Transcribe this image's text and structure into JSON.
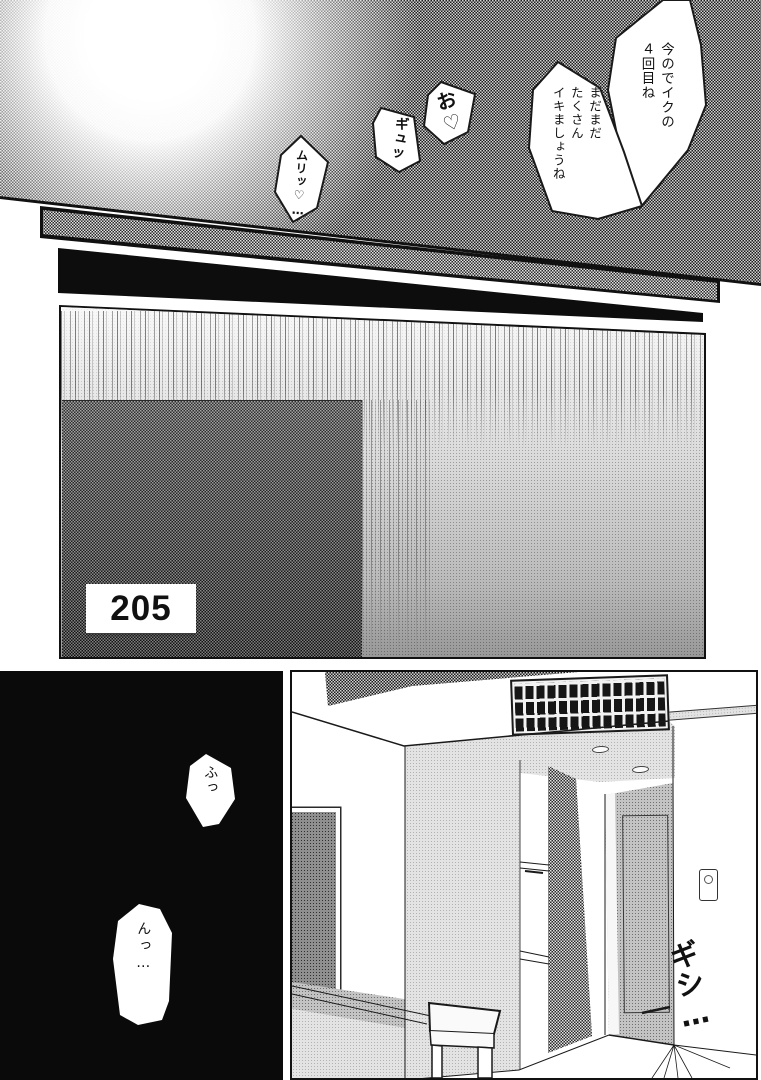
{
  "colors": {
    "ink": "#111111",
    "paper": "#ffffff",
    "panel_black": "#0a0a0a"
  },
  "top_panel": {
    "bubble_iku": "今のでイクの\n４回目ね",
    "bubble_mada": "まだまだ\nたくさん\nイキましょうね",
    "sfx_o": "お♡",
    "sfx_gyu": "ギュッ",
    "sfx_muri": "ムリッ♡…"
  },
  "door_panel": {
    "room_number": "205"
  },
  "dark_panel": {
    "bubble_fu": "ふっ",
    "bubble_n": "んっ…"
  },
  "room_panel": {
    "sfx_gishi": "ギシ…"
  }
}
